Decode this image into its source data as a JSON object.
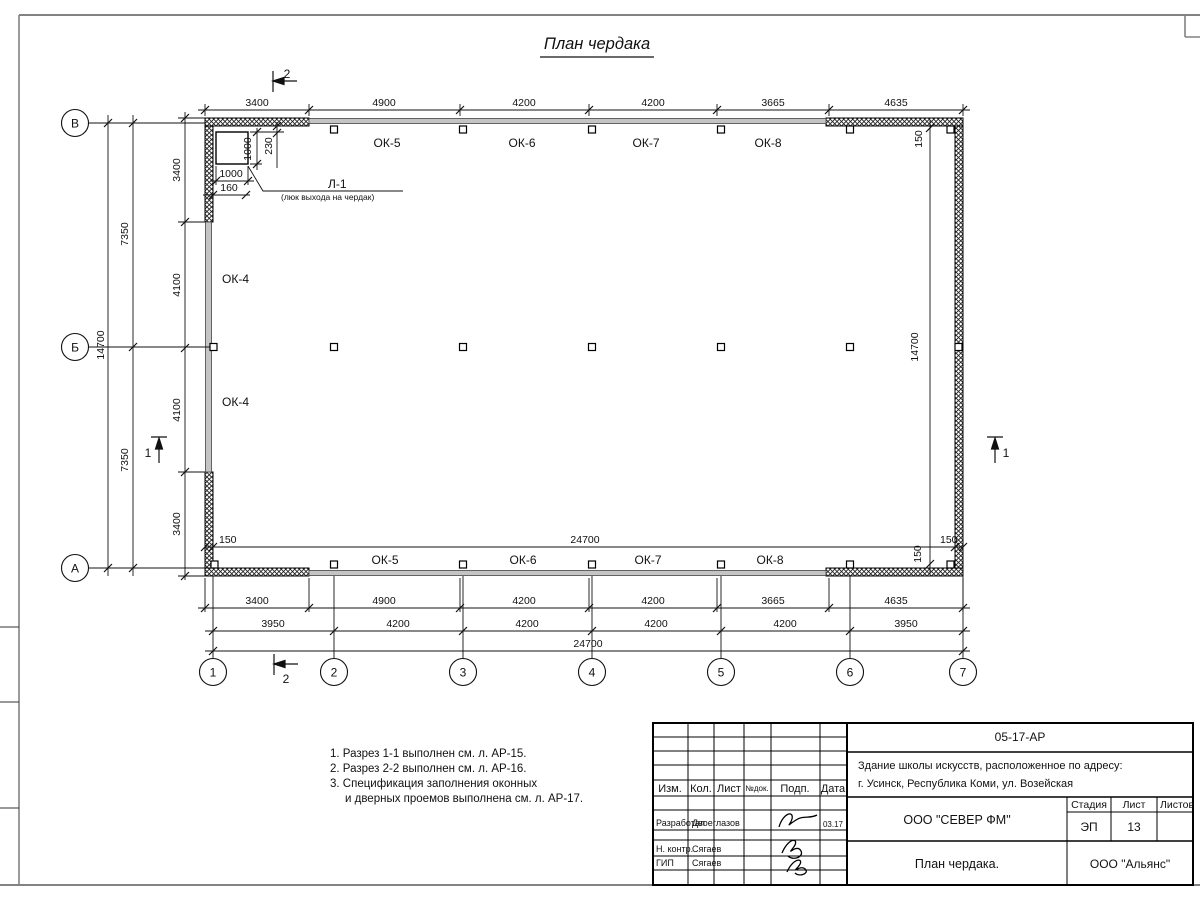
{
  "title": "План чердака",
  "plan": {
    "windows_top": [
      "ОК-5",
      "ОК-6",
      "ОК-7",
      "ОК-8"
    ],
    "windows_bottom": [
      "ОК-5",
      "ОК-6",
      "ОК-7",
      "ОК-8"
    ],
    "wall_window_upper": "ОК-4",
    "wall_window_lower": "ОК-4",
    "hatch_label": "Л-1",
    "hatch_sublabel": "(люк выхода на чердак)",
    "hatch_dim_width": "1000",
    "hatch_dim_height": "1000",
    "hatch_dim_offset_left": "160",
    "hatch_dim_offset_top": "230"
  },
  "dims": {
    "top": [
      "3400",
      "4900",
      "4200",
      "4200",
      "3665",
      "4635"
    ],
    "bottom_outer": [
      "3400",
      "4900",
      "4200",
      "4200",
      "3665",
      "4635"
    ],
    "bottom_axes": [
      "3950",
      "4200",
      "4200",
      "4200",
      "4200",
      "3950"
    ],
    "bottom_total": "24700",
    "left_outer_total": "14700",
    "left_halves": [
      "7350",
      "7350"
    ],
    "left_inner": [
      "3400",
      "4100",
      "4100",
      "3400"
    ],
    "interior_width_total": "24700",
    "interior_left_150": "150",
    "interior_right_150": "150",
    "interior_wall_top_150": "150",
    "interior_wall_bottom_150": "150",
    "interior_height_total": "14700"
  },
  "axes": {
    "rows": [
      "В",
      "Б",
      "А"
    ],
    "cols": [
      "1",
      "2",
      "3",
      "4",
      "5",
      "6",
      "7"
    ]
  },
  "sections": {
    "cut1": "1",
    "cut2": "2"
  },
  "notes": [
    "1. Разрез 1-1 выполнен см. л. АР-15.",
    "2. Разрез 2-2 выполнен см. л. АР-16.",
    "3. Спецификация заполнения оконных",
    "и дверных проемов выполнена см. л. АР-17."
  ],
  "titleblock": {
    "doc_number": "05-17-АР",
    "project_line1": "Здание школы искусств, расположенное по адресу:",
    "project_line2": "г. Усинск, Республика Коми, ул. Возейская",
    "cols": [
      "Изм.",
      "Кол.",
      "Лист",
      "№док.",
      "Подп.",
      "Дата"
    ],
    "row_developed_label": "Разработал",
    "row_developed_name": "Двоеглазов",
    "row_developed_date": "03.17",
    "row_ncontrol_label": "Н. контр.",
    "row_ncontrol_name": "Сягаев",
    "row_gip_label": "ГИП",
    "row_gip_name": "Сягаев",
    "company": "ООО \"СЕВЕР ФМ\"",
    "stage_label": "Стадия",
    "sheet_label": "Лист",
    "sheets_label": "Листов",
    "stage_value": "ЭП",
    "sheet_value": "13",
    "drawing_title": "План чердака.",
    "org": "ООО \"Альянс\""
  }
}
